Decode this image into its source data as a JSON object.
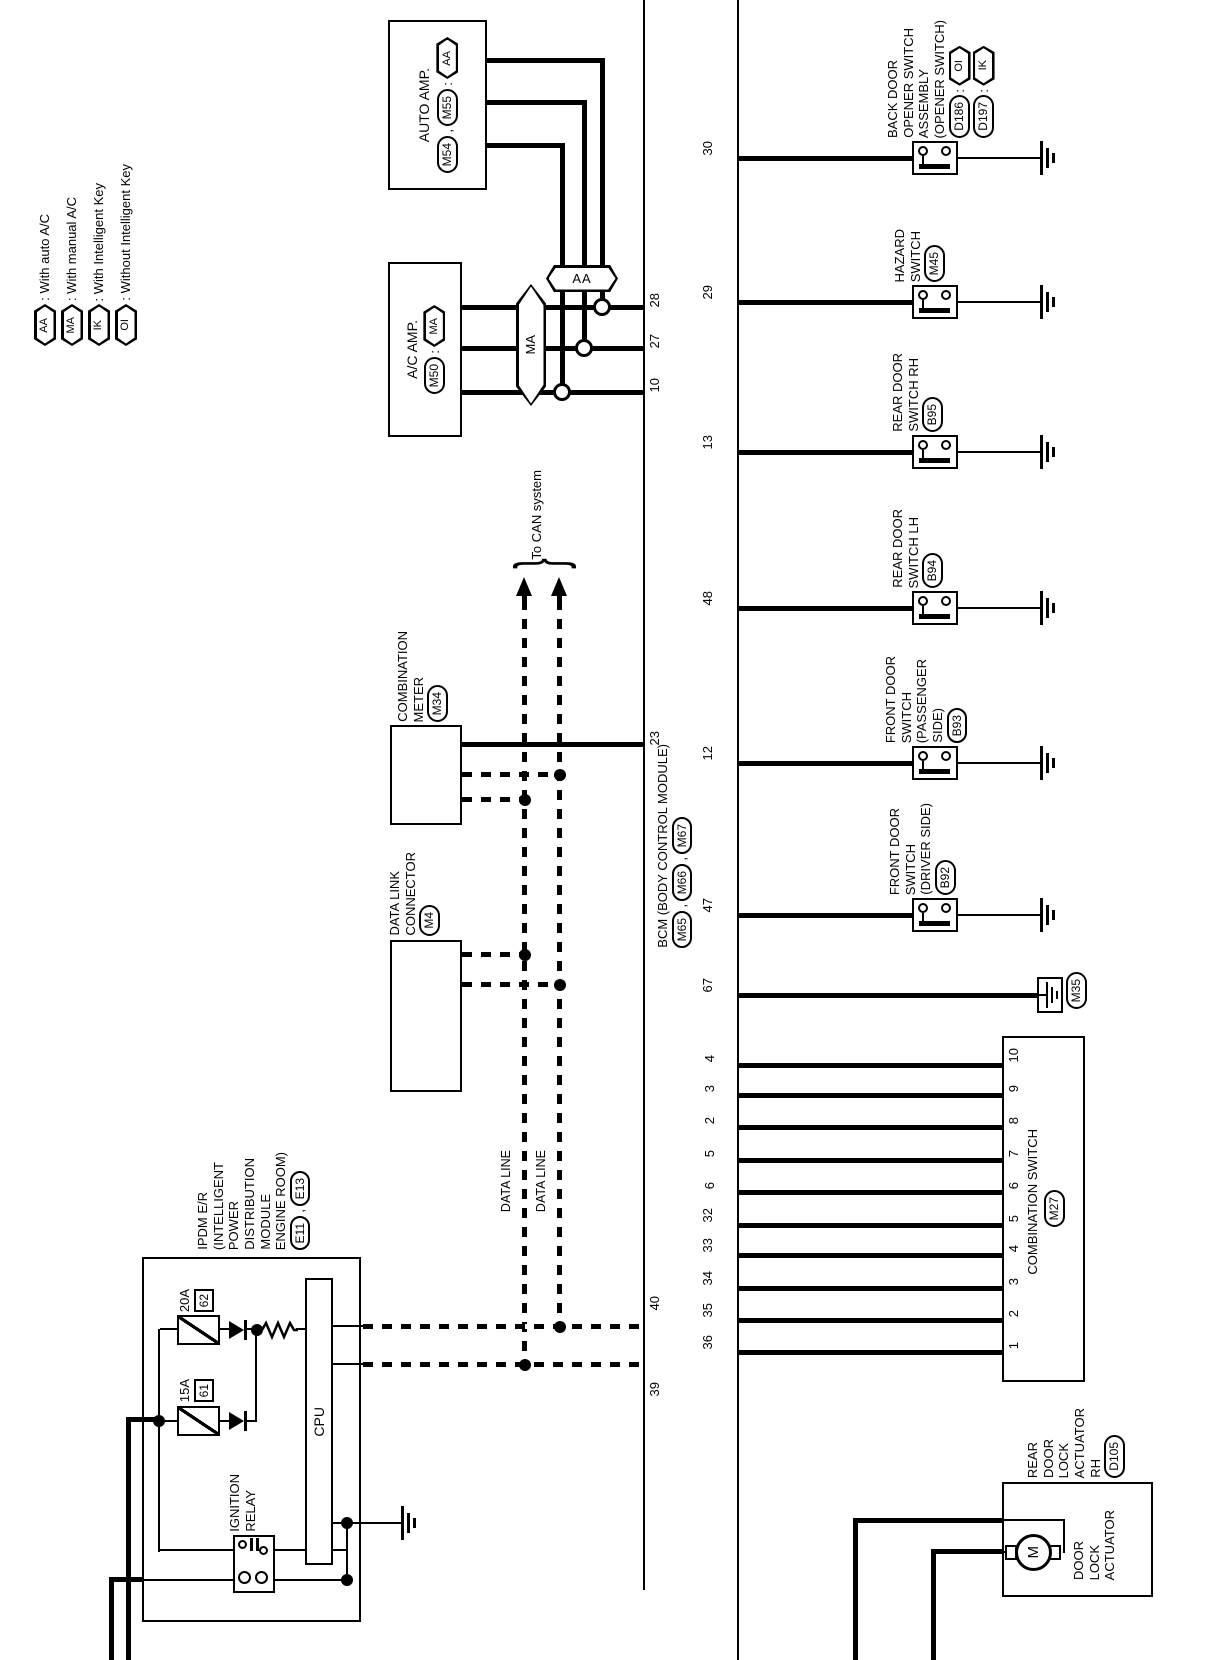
{
  "colors": {
    "ink": "#000000",
    "paper": "#ffffff"
  },
  "legend": {
    "items": [
      {
        "tag": "AA",
        "label": ": With auto A/C"
      },
      {
        "tag": "MA",
        "label": ": With manual A/C"
      },
      {
        "tag": "IK",
        "label": ": With Intelligent Key"
      },
      {
        "tag": "OI",
        "label": ": Without Intelligent Key"
      }
    ]
  },
  "auto_amp": {
    "title": "AUTO AMP.",
    "conn1": "M54",
    "sep": ",",
    "conn2": "M55",
    "colon": ":",
    "tag": "AA"
  },
  "ac_amp": {
    "title": "A/C AMP.",
    "conn": "M50",
    "colon": ":",
    "tag": "MA"
  },
  "bus_tags": {
    "aa": "AA",
    "ma": "MA"
  },
  "can": {
    "label": "To CAN system",
    "data_line_1": "DATA LINE",
    "data_line_2": "DATA LINE"
  },
  "combination_meter": {
    "l1": "COMBINATION",
    "l2": "METER",
    "conn": "M34"
  },
  "dlc": {
    "l1": "DATA LINK",
    "l2": "CONNECTOR",
    "conn": "M4"
  },
  "bcm": {
    "title": "BCM (BODY CONTROL MODULE)",
    "conn1": "M65",
    "sep1": ",",
    "conn2": "M66",
    "sep2": ",",
    "conn3": "M67",
    "left_pins": [
      "28",
      "27",
      "10",
      "23",
      "40",
      "39"
    ],
    "right_pins": [
      "30",
      "29",
      "13",
      "48",
      "12",
      "47",
      "67",
      "4",
      "3",
      "2",
      "5",
      "6",
      "32",
      "33",
      "34",
      "35",
      "36"
    ]
  },
  "ipdm": {
    "l1": "IPDM E/R",
    "l2": "(INTELLIGENT",
    "l3": "POWER",
    "l4": "DISTRIBUTION",
    "l5": "MODULE",
    "l6": "ENGINE ROOM)",
    "conn1": "E11",
    "sep": ",",
    "conn2": "E13",
    "fuse1_rating": "20A",
    "fuse1_id": "62",
    "fuse2_rating": "15A",
    "fuse2_id": "61",
    "cpu": "CPU",
    "relay_l1": "IGNITION",
    "relay_l2": "RELAY"
  },
  "devices": {
    "back_door": {
      "l1": "BACK DOOR",
      "l2": "OPENER SWITCH",
      "l3": "ASSEMBLY",
      "l4": "(OPENER SWITCH)",
      "conn1": "D186",
      "colon1": ":",
      "tag1": "OI",
      "conn2": "D197",
      "colon2": ":",
      "tag2": "IK"
    },
    "hazard": {
      "l1": "HAZARD",
      "l2": "SWITCH",
      "conn": "M45"
    },
    "rear_rh": {
      "l1": "REAR DOOR",
      "l2": "SWITCH RH",
      "conn": "B95"
    },
    "rear_lh": {
      "l1": "REAR DOOR",
      "l2": "SWITCH LH",
      "conn": "B94"
    },
    "front_pass": {
      "l1": "FRONT DOOR",
      "l2": "SWITCH",
      "l3": "(PASSENGER",
      "l4": "SIDE)",
      "conn": "B93"
    },
    "front_drv": {
      "l1": "FRONT DOOR",
      "l2": "SWITCH",
      "l3": "(DRIVER SIDE)",
      "conn": "B92"
    },
    "ground_conn": "M35"
  },
  "combination_switch": {
    "title": "COMBINATION SWITCH",
    "conn": "M27",
    "pins": [
      "10",
      "9",
      "8",
      "7",
      "6",
      "5",
      "4",
      "3",
      "2",
      "1"
    ]
  },
  "actuator": {
    "l1": "REAR",
    "l2": "DOOR",
    "l3": "LOCK",
    "l4": "ACTUATOR",
    "l5": "RH",
    "conn": "D105",
    "inner1": "DOOR",
    "inner2": "LOCK",
    "inner3": "ACTUATOR",
    "motor": "M"
  }
}
